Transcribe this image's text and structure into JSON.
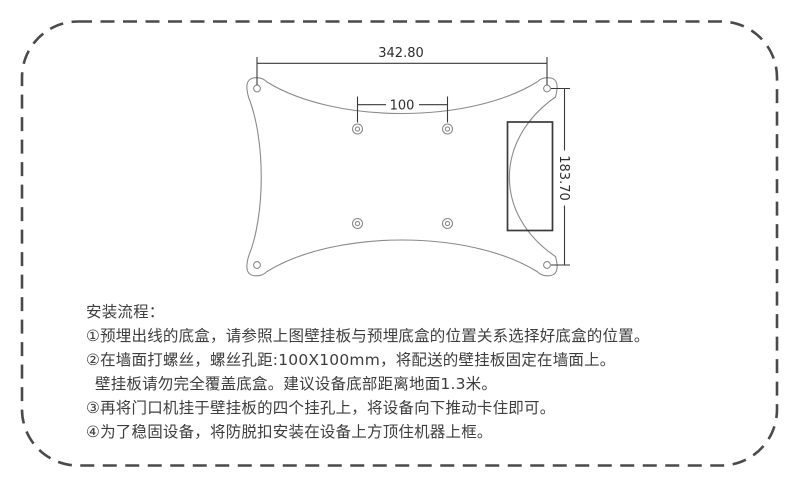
{
  "page": {
    "background": "#ffffff",
    "border_color": "#4a4a4a",
    "ink_color": "#3d3d3d"
  },
  "diagram": {
    "description": "wall-mount-plate-technical-drawing",
    "outline_color": "#8a8a8a",
    "dim_color": "#3a3a3a",
    "dim_width": "342.80",
    "dim_hole_spacing": "100",
    "dim_height": "183.70"
  },
  "instructions": {
    "title": "安装流程：",
    "steps": [
      "①预埋出线的底盒，请参照上图壁挂板与预埋底盒的位置关系选择好底盒的位置。",
      "②在墙面打螺丝，螺丝孔距:100X100mm，将配送的壁挂板固定在墙面上。",
      "壁挂板请勿完全覆盖底盒。建议设备底部距离地面1.3米。",
      "③再将门口机挂于壁挂板的四个挂孔上，将设备向下推动卡住即可。",
      "④为了稳固设备，将防脱扣安装在设备上方顶住机器上框。"
    ]
  }
}
